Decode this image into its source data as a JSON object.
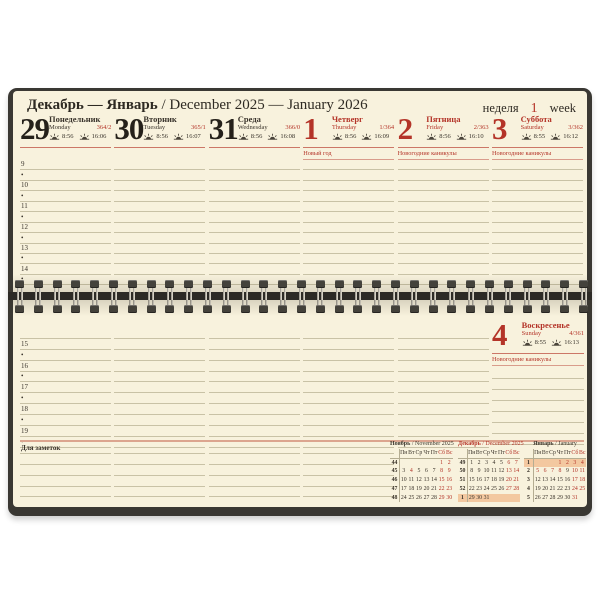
{
  "header": {
    "title_ru": "Декабрь — Январь",
    "title_rest": " / December 2025 — January 2026",
    "week_label_ru": "неделя",
    "week_number": "1",
    "week_label_en": "week"
  },
  "days": [
    {
      "num": "29",
      "ru": "Понедельник",
      "en": "Monday",
      "doy": "364/2",
      "sunrise": "8:56",
      "sunset": "16:06",
      "holiday": "",
      "red": false
    },
    {
      "num": "30",
      "ru": "Вторник",
      "en": "Tuesday",
      "doy": "365/1",
      "sunrise": "8:56",
      "sunset": "16:07",
      "holiday": "",
      "red": false
    },
    {
      "num": "31",
      "ru": "Среда",
      "en": "Wednesday",
      "doy": "366/0",
      "sunrise": "8:56",
      "sunset": "16:08",
      "holiday": "",
      "red": false
    },
    {
      "num": "1",
      "ru": "Четверг",
      "en": "Thursday",
      "doy": "1/364",
      "sunrise": "8:56",
      "sunset": "16:09",
      "holiday": "Новый год",
      "red": true
    },
    {
      "num": "2",
      "ru": "Пятница",
      "en": "Friday",
      "doy": "2/363",
      "sunrise": "8:56",
      "sunset": "16:10",
      "holiday": "Новогодние каникулы",
      "red": true
    },
    {
      "num": "3",
      "ru": "Суббота",
      "en": "Saturday",
      "doy": "3/362",
      "sunrise": "8:55",
      "sunset": "16:12",
      "holiday": "Новогодние каникулы",
      "red": true
    }
  ],
  "sunday": {
    "num": "4",
    "ru": "Воскресенье",
    "en": "Sunday",
    "doy": "4/361",
    "sunrise": "8:55",
    "sunset": "16:13",
    "holiday": "Новогодние каникулы",
    "red": true
  },
  "top_time_rows": [
    "9",
    "•",
    "10",
    "•",
    "11",
    "•",
    "12",
    "•",
    "13",
    "•",
    "14",
    "•"
  ],
  "bottom_time_rows": [
    "",
    "15",
    "•",
    "16",
    "•",
    "17",
    "•",
    "18",
    "•",
    "19",
    "•"
  ],
  "notes": {
    "label": "Для заметок",
    "lines_per_column": 5,
    "columns": 4
  },
  "mini_calendars": {
    "weekday_headers": [
      "Пн",
      "Вт",
      "Ср",
      "Чт",
      "Пт",
      "Сб",
      "Вс"
    ],
    "months": [
      {
        "title_ru": "Ноябрь",
        "title_en": "/ November 2025",
        "title_red": false,
        "week_numbers": [
          "44",
          "45",
          "46",
          "47",
          "48"
        ],
        "weeks": [
          [
            "",
            "",
            "",
            "",
            "",
            "1",
            "2"
          ],
          [
            "3",
            "4",
            "5",
            "6",
            "7",
            "8",
            "9"
          ],
          [
            "10",
            "11",
            "12",
            "13",
            "14",
            "15",
            "16"
          ],
          [
            "17",
            "18",
            "19",
            "20",
            "21",
            "22",
            "23"
          ],
          [
            "24",
            "25",
            "26",
            "27",
            "28",
            "29",
            "30"
          ]
        ],
        "red_dates": [
          "1",
          "2",
          "4",
          "8",
          "9",
          "15",
          "16",
          "22",
          "23",
          "29",
          "30"
        ],
        "highlight_week": -1
      },
      {
        "title_ru": "Декабрь",
        "title_en": "/ December 2025",
        "title_red": true,
        "week_numbers": [
          "49",
          "50",
          "51",
          "52",
          "1"
        ],
        "weeks": [
          [
            "1",
            "2",
            "3",
            "4",
            "5",
            "6",
            "7"
          ],
          [
            "8",
            "9",
            "10",
            "11",
            "12",
            "13",
            "14"
          ],
          [
            "15",
            "16",
            "17",
            "18",
            "19",
            "20",
            "21"
          ],
          [
            "22",
            "23",
            "24",
            "25",
            "26",
            "27",
            "28"
          ],
          [
            "29",
            "30",
            "31",
            "",
            "",
            "",
            ""
          ]
        ],
        "red_dates": [
          "6",
          "7",
          "13",
          "14",
          "20",
          "21",
          "27",
          "28"
        ],
        "highlight_week": 4
      },
      {
        "title_ru": "Январь",
        "title_en": "/ January",
        "title_red": false,
        "week_numbers": [
          "1",
          "2",
          "3",
          "4",
          "5"
        ],
        "weeks": [
          [
            "",
            "",
            "",
            "1",
            "2",
            "3",
            "4"
          ],
          [
            "5",
            "6",
            "7",
            "8",
            "9",
            "10",
            "11"
          ],
          [
            "12",
            "13",
            "14",
            "15",
            "16",
            "17",
            "18"
          ],
          [
            "19",
            "20",
            "21",
            "22",
            "23",
            "24",
            "25"
          ],
          [
            "26",
            "27",
            "28",
            "29",
            "30",
            "31",
            ""
          ]
        ],
        "red_dates": [
          "1",
          "2",
          "3",
          "4",
          "5",
          "6",
          "7",
          "8",
          "10",
          "11",
          "17",
          "18",
          "24",
          "25",
          "31"
        ],
        "highlight_week": 0
      }
    ]
  },
  "colors": {
    "accent_red": "#b43428",
    "page_cream": "#f8f2dd",
    "rule_tan": "#c9c2a6",
    "cover_dark": "#3a3833",
    "notes_divider_pink": "#dca58f",
    "current_week_highlight": "#f3c8a0"
  }
}
